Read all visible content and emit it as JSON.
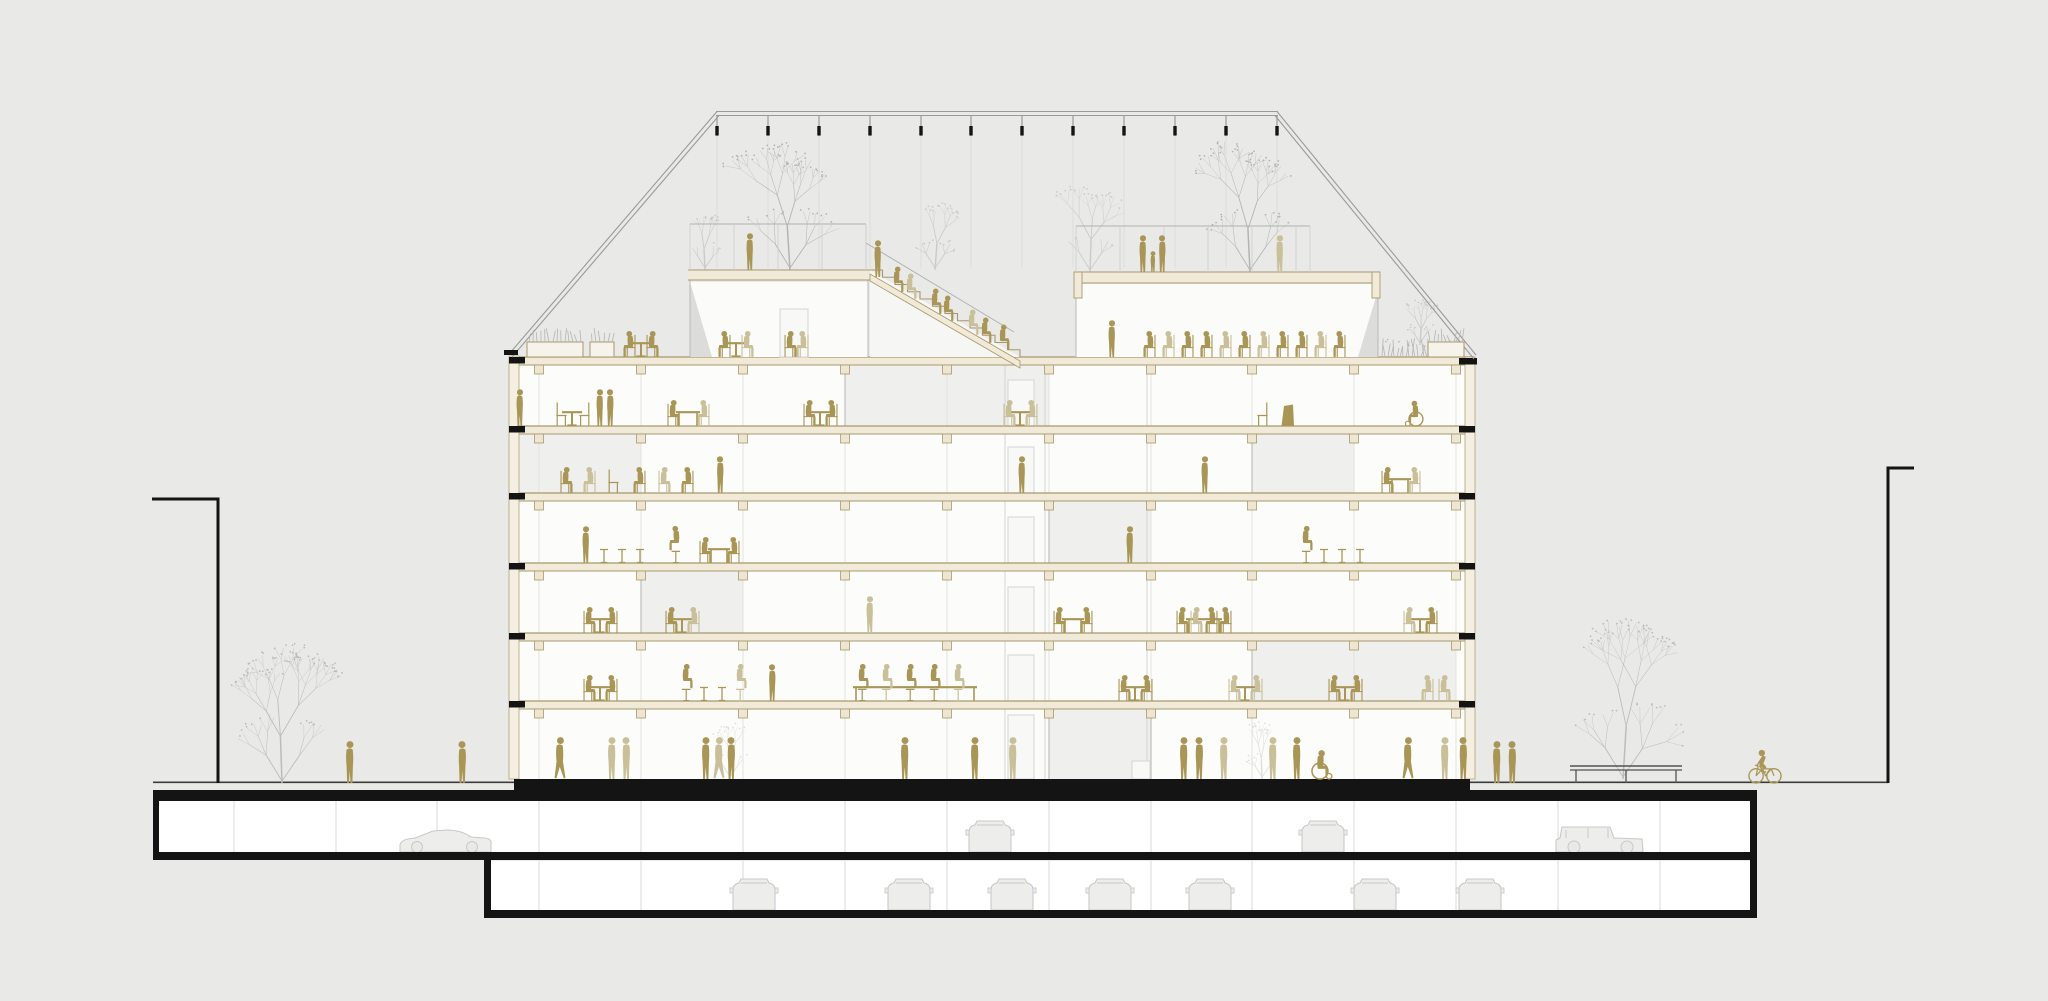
{
  "title": "Building cross-section architectural drawing",
  "canvas": {
    "w": 2048,
    "h": 1001
  },
  "colors": {
    "background": "#e9e9e8",
    "ink": "#141414",
    "street_line": "#3c3c3a",
    "interior": "#fcfcfb",
    "room_tint": "#efefed",
    "pavilion_fill": "#fbfbf9",
    "slab_fill": "#f1ead9",
    "slab_line": "#a8986b",
    "capital_fill": "#eee6d2",
    "wall_fill": "#f4efe1",
    "mullion": "#e2e2e0",
    "partition": "#c6c6c4",
    "shaft": "#d3d3d1",
    "door_line": "#d8d8d6",
    "door_fill": "#f8f8f6",
    "glass_line": "#b9b9b7",
    "sliver": "#dcdcda",
    "rail": "#b1b1af",
    "parapet_pick": "#cfcfcd",
    "pergola": "#9a9a98",
    "cable": "#dcdcda",
    "person_dark": "#a99657",
    "person_light": "#c9c09a",
    "car_line": "#c9c9c7",
    "car_fill": "#ededec",
    "tree_gray": "#b4b4b2",
    "tree_light": "#cbcbc9",
    "tree_street": "#bcbcba",
    "tree_faint": "#e1e0de",
    "bench": "#55534e"
  },
  "pergola": {
    "top_y": 114,
    "x1": 717,
    "x2": 1277,
    "posts": [
      717,
      768,
      819,
      870,
      921,
      971,
      1022,
      1073,
      1124,
      1175,
      1226,
      1277
    ],
    "eave_left": {
      "x": 512,
      "y": 356
    },
    "eave_right": {
      "x": 1474,
      "y": 358
    },
    "cable_y2": 268
  },
  "building": {
    "left": 514,
    "right": 1470,
    "roof_slab_y": 357,
    "slab_ys": [
      357,
      426,
      493,
      563,
      633,
      701
    ],
    "slab_h": 8,
    "ground_y": 779,
    "columns": [
      539,
      641,
      743,
      845,
      947,
      1049,
      1151,
      1252,
      1354,
      1456
    ],
    "floor_bounds": [
      [
        365,
        426
      ],
      [
        434,
        493
      ],
      [
        501,
        563
      ],
      [
        571,
        633
      ],
      [
        641,
        701
      ],
      [
        709,
        779
      ]
    ],
    "tinted_rooms": [
      {
        "floor": 0,
        "x1": 845,
        "x2": 1049
      },
      {
        "floor": 1,
        "x1": 514,
        "x2": 641
      },
      {
        "floor": 1,
        "x1": 1252,
        "x2": 1354
      },
      {
        "floor": 2,
        "x1": 1049,
        "x2": 1151
      },
      {
        "floor": 3,
        "x1": 641,
        "x2": 743
      },
      {
        "floor": 4,
        "x1": 1252,
        "x2": 1456
      },
      {
        "floor": 5,
        "x1": 1049,
        "x2": 1151
      }
    ],
    "partitions": [
      {
        "floor": 0,
        "x": 845
      },
      {
        "floor": 1,
        "x": 1252
      },
      {
        "floor": 2,
        "x": 1049
      },
      {
        "floor": 3,
        "x": 641
      },
      {
        "floor": 4,
        "x": 1252
      },
      {
        "floor": 5,
        "x": 1049
      },
      {
        "floor": 5,
        "x": 1151
      }
    ],
    "shafts": [
      1005,
      1045,
      1147
    ],
    "doors": [
      {
        "floor": 0,
        "x": 1008,
        "w": 26,
        "h": 46
      },
      {
        "floor": 1,
        "x": 1008,
        "w": 26,
        "h": 46
      },
      {
        "floor": 2,
        "x": 1008,
        "w": 26,
        "h": 46
      },
      {
        "floor": 3,
        "x": 1008,
        "w": 26,
        "h": 46
      },
      {
        "floor": 4,
        "x": 1008,
        "w": 26,
        "h": 46
      },
      {
        "floor": 5,
        "x": 1008,
        "w": 26,
        "h": 64
      },
      {
        "floor": 5,
        "x": 1132,
        "w": 18,
        "h": 18
      }
    ]
  },
  "roof": {
    "upper_terrace": {
      "x1": 688,
      "x2": 870,
      "y": 270,
      "h": 10
    },
    "canopy": {
      "x1": 1074,
      "x2": 1380,
      "y": 272,
      "h": 11
    },
    "parapet_rail_y": 224,
    "parapet_ranges": [
      [
        690,
        866,
        224,
        270
      ],
      [
        1076,
        1310,
        226,
        272
      ]
    ],
    "stair": {
      "x1": 870,
      "y1": 270,
      "x2": 1020,
      "y2": 357,
      "steps": 12
    },
    "glass_walls": [
      [
        690,
        270,
        357
      ],
      [
        868,
        270,
        357
      ],
      [
        1076,
        284,
        357
      ],
      [
        1378,
        284,
        357
      ]
    ],
    "slivers": [
      [
        690,
        282,
        712,
        357
      ],
      [
        1378,
        290,
        1358,
        357
      ]
    ]
  },
  "site": {
    "street_y": 783,
    "street_x1": 153,
    "street_x2": 1888,
    "left_mark": {
      "x1": 152,
      "x2": 218,
      "y_top": 499,
      "y_bot": 783
    },
    "right_mark": {
      "x": 1888,
      "y_top": 468,
      "y_bot": 783,
      "tick_x2": 1914
    }
  },
  "basement": {
    "b1": {
      "x1": 153,
      "x2": 1757,
      "top": 790,
      "floor": 852,
      "int_top": 801,
      "int_bot": 852
    },
    "b2": {
      "x1": 484,
      "x2": 1757,
      "top": 858,
      "floor": 910,
      "int_top": 861,
      "int_bot": 910
    },
    "under_building_band": {
      "x1": 514,
      "x2": 1470,
      "y1": 779,
      "y2": 801
    },
    "columns_b1": [
      234,
      336,
      437,
      539,
      641,
      743,
      845,
      947,
      1049,
      1151,
      1252,
      1354,
      1456,
      1558,
      1660
    ],
    "columns_b2": [
      539,
      641,
      743,
      845,
      947,
      1049,
      1151,
      1252,
      1354,
      1456,
      1558,
      1660
    ]
  },
  "cars": [
    {
      "type": "side",
      "x": 445,
      "y": 852,
      "flip": 1
    },
    {
      "type": "front",
      "x": 990,
      "y": 852,
      "flip": 0
    },
    {
      "type": "front",
      "x": 1323,
      "y": 852,
      "flip": 0
    },
    {
      "type": "jeep",
      "x": 1600,
      "y": 852,
      "flip": 0
    },
    {
      "type": "front",
      "x": 754,
      "y": 910,
      "flip": 0
    },
    {
      "type": "front",
      "x": 909,
      "y": 910,
      "flip": 0
    },
    {
      "type": "front",
      "x": 1012,
      "y": 910,
      "flip": 0
    },
    {
      "type": "front",
      "x": 1110,
      "y": 910,
      "flip": 0
    },
    {
      "type": "front",
      "x": 1210,
      "y": 910,
      "flip": 0
    },
    {
      "type": "front",
      "x": 1375,
      "y": 910,
      "flip": 0
    },
    {
      "type": "front",
      "x": 1480,
      "y": 910,
      "flip": 0
    }
  ],
  "trees": [
    {
      "x": 790,
      "y": 270,
      "h": 128,
      "tone": "tree_gray",
      "seed": 11
    },
    {
      "x": 705,
      "y": 270,
      "h": 62,
      "tone": "tree_light",
      "seed": 12
    },
    {
      "x": 935,
      "y": 270,
      "h": 78,
      "tone": "tree_light",
      "seed": 13
    },
    {
      "x": 1090,
      "y": 272,
      "h": 96,
      "tone": "tree_light",
      "seed": 14
    },
    {
      "x": 1250,
      "y": 272,
      "h": 126,
      "tone": "tree_gray",
      "seed": 15
    },
    {
      "x": 1420,
      "y": 345,
      "h": 46,
      "tone": "tree_light",
      "seed": 16
    },
    {
      "x": 282,
      "y": 783,
      "h": 138,
      "tone": "tree_street",
      "seed": 17
    },
    {
      "x": 1623,
      "y": 779,
      "h": 156,
      "tone": "tree_street",
      "seed": 18
    },
    {
      "x": 730,
      "y": 779,
      "h": 62,
      "tone": "tree_faint",
      "seed": 19
    },
    {
      "x": 1262,
      "y": 779,
      "h": 60,
      "tone": "tree_faint",
      "seed": 20
    }
  ],
  "furniture": [
    [
      "planter",
      527,
      357,
      0,
      56
    ],
    [
      "planter",
      590,
      357,
      0,
      24
    ],
    [
      "tableRound",
      641,
      357,
      0,
      24
    ],
    [
      "tableRound",
      736,
      357,
      0,
      24
    ],
    [
      "shrubs",
      1382,
      357,
      0,
      78
    ],
    [
      "planterBox",
      1428,
      357,
      0,
      36
    ],
    [
      "chairEmpty",
      562,
      426,
      0
    ],
    [
      "tableRound",
      572,
      426,
      0,
      20
    ],
    [
      "chairEmpty",
      584,
      426,
      1
    ],
    [
      "tableMeet",
      688,
      426,
      0,
      24
    ],
    [
      "tableRound",
      820,
      426,
      0,
      24
    ],
    [
      "tableRound",
      1020,
      426,
      0,
      24
    ],
    [
      "chairEmpty",
      1262,
      426,
      1
    ],
    [
      "lectern",
      1288,
      426,
      0
    ],
    [
      "chairEmpty",
      614,
      493,
      0
    ],
    [
      "tableMeet",
      1400,
      493,
      0,
      22
    ],
    [
      "stool",
      604,
      563
    ],
    [
      "stool",
      622,
      563
    ],
    [
      "stool",
      640,
      563
    ],
    [
      "tableMeet",
      719,
      563,
      0,
      22
    ],
    [
      "stool",
      1324,
      563
    ],
    [
      "stool",
      1342,
      563
    ],
    [
      "stool",
      1360,
      563
    ],
    [
      "tableRound",
      600,
      633,
      0,
      22
    ],
    [
      "tableRound",
      682,
      633,
      0,
      22
    ],
    [
      "tableMeet",
      1073,
      633,
      0,
      22
    ],
    [
      "tableMeet",
      1204,
      633,
      0,
      36
    ],
    [
      "tableRound",
      1420,
      633,
      0,
      22
    ],
    [
      "tableRound",
      600,
      701,
      0,
      22
    ],
    [
      "stool",
      704,
      701
    ],
    [
      "stool",
      722,
      701
    ],
    [
      "tableMeet",
      915,
      701,
      0,
      124
    ],
    [
      "tableRound",
      1135,
      701,
      0,
      22
    ],
    [
      "tableRound",
      1245,
      701,
      0,
      22
    ],
    [
      "tableRound",
      1345,
      701,
      0,
      22
    ],
    [
      "bench",
      1626,
      783,
      0,
      112
    ]
  ],
  "figures": [
    [
      "sitChair",
      630,
      357,
      "d",
      1
    ],
    [
      "sitChair",
      652,
      357,
      "d",
      0
    ],
    [
      "sitChair",
      725,
      357,
      "d",
      1
    ],
    [
      "sitChair",
      747,
      357,
      "l",
      0
    ],
    [
      "sitChair",
      790,
      357,
      "d",
      0
    ],
    [
      "sitChair",
      803,
      357,
      "l",
      1
    ],
    [
      "stand",
      750,
      270,
      "d",
      0
    ],
    [
      "stand",
      878,
      277,
      "d",
      0
    ],
    [
      "sitStep",
      897,
      292,
      "d",
      0
    ],
    [
      "sitStep",
      910,
      299,
      "l",
      0
    ],
    [
      "sitStep",
      935,
      314,
      "d",
      0
    ],
    [
      "sitStep",
      947,
      321,
      "d",
      0
    ],
    [
      "sitStep",
      972,
      335,
      "l",
      0
    ],
    [
      "sitStep",
      985,
      343,
      "d",
      0
    ],
    [
      "sitStep",
      1003,
      350,
      "d",
      0
    ],
    [
      "stand",
      1143,
      272,
      "d",
      0
    ],
    [
      "child",
      1153,
      272,
      "d",
      0
    ],
    [
      "stand",
      1162,
      272,
      "d",
      1
    ],
    [
      "stand",
      1280,
      272,
      "l",
      0
    ],
    [
      "stand",
      1112,
      357,
      "d",
      0
    ],
    [
      "sitChair",
      1150,
      357,
      "d",
      1
    ],
    [
      "sitChair",
      1169,
      357,
      "l",
      1
    ],
    [
      "sitChair",
      1188,
      357,
      "d",
      1
    ],
    [
      "sitChair",
      1207,
      357,
      "d",
      1
    ],
    [
      "sitChair",
      1226,
      357,
      "l",
      1
    ],
    [
      "sitChair",
      1245,
      357,
      "d",
      1
    ],
    [
      "sitChair",
      1264,
      357,
      "l",
      1
    ],
    [
      "sitChair",
      1283,
      357,
      "d",
      1
    ],
    [
      "sitChair",
      1302,
      357,
      "d",
      1
    ],
    [
      "sitChair",
      1321,
      357,
      "l",
      1
    ],
    [
      "sitChair",
      1340,
      357,
      "d",
      1
    ],
    [
      "stand",
      520,
      426,
      "d",
      0
    ],
    [
      "stand",
      600,
      426,
      "d",
      0
    ],
    [
      "stand",
      610,
      426,
      "d",
      1
    ],
    [
      "sitChair",
      673,
      426,
      "d",
      0
    ],
    [
      "sitChair",
      704,
      426,
      "l",
      1
    ],
    [
      "sitChair",
      809,
      426,
      "d",
      0
    ],
    [
      "sitChair",
      832,
      426,
      "d",
      1
    ],
    [
      "sitChair",
      1009,
      426,
      "l",
      0
    ],
    [
      "sitChair",
      1032,
      426,
      "l",
      1
    ],
    [
      "wheelchair",
      1415,
      426,
      "d",
      1
    ],
    [
      "sitChair",
      566,
      493,
      "d",
      0
    ],
    [
      "sitChair",
      590,
      493,
      "l",
      1
    ],
    [
      "sitChair",
      640,
      493,
      "d",
      1
    ],
    [
      "sitChair",
      664,
      493,
      "l",
      0
    ],
    [
      "sitChair",
      688,
      493,
      "d",
      1
    ],
    [
      "stand",
      720,
      493,
      "d",
      1
    ],
    [
      "stand",
      1022,
      493,
      "d",
      0
    ],
    [
      "stand",
      1205,
      493,
      "d",
      0
    ],
    [
      "sitChair",
      1387,
      493,
      "d",
      0
    ],
    [
      "sitChair",
      1415,
      493,
      "l",
      1
    ],
    [
      "stand",
      586,
      563,
      "d",
      0
    ],
    [
      "sitStool",
      676,
      563,
      "d",
      1
    ],
    [
      "sitChair",
      705,
      563,
      "d",
      0
    ],
    [
      "sitChair",
      734,
      563,
      "d",
      1
    ],
    [
      "stand",
      1130,
      563,
      "d",
      0
    ],
    [
      "sitStool",
      1306,
      563,
      "d",
      0
    ],
    [
      "sitChair",
      589,
      633,
      "d",
      0
    ],
    [
      "sitChair",
      612,
      633,
      "d",
      1
    ],
    [
      "sitChair",
      671,
      633,
      "d",
      0
    ],
    [
      "sitChair",
      694,
      633,
      "l",
      1
    ],
    [
      "stand",
      870,
      633,
      "l",
      0
    ],
    [
      "sitChair",
      1059,
      633,
      "d",
      0
    ],
    [
      "sitChair",
      1087,
      633,
      "d",
      1
    ],
    [
      "sitChair",
      1182,
      633,
      "d",
      0
    ],
    [
      "sitChair",
      1196,
      633,
      "l",
      0
    ],
    [
      "sitChair",
      1212,
      633,
      "d",
      1
    ],
    [
      "sitChair",
      1226,
      633,
      "d",
      1
    ],
    [
      "sitChair",
      1409,
      633,
      "l",
      0
    ],
    [
      "sitChair",
      1432,
      633,
      "d",
      1
    ],
    [
      "sitChair",
      589,
      701,
      "d",
      0
    ],
    [
      "sitChair",
      612,
      701,
      "d",
      1
    ],
    [
      "sitStool",
      686,
      701,
      "d",
      0
    ],
    [
      "sitStool",
      740,
      701,
      "l",
      0
    ],
    [
      "stand",
      772,
      701,
      "d",
      1
    ],
    [
      "sitStool",
      862,
      701,
      "d",
      0
    ],
    [
      "sitStool",
      886,
      701,
      "l",
      0
    ],
    [
      "sitStool",
      910,
      701,
      "d",
      0
    ],
    [
      "sitStool",
      934,
      701,
      "d",
      0
    ],
    [
      "sitStool",
      958,
      701,
      "l",
      0
    ],
    [
      "sitChair",
      1124,
      701,
      "d",
      0
    ],
    [
      "sitChair",
      1147,
      701,
      "d",
      1
    ],
    [
      "sitChair",
      1234,
      701,
      "l",
      0
    ],
    [
      "sitChair",
      1257,
      701,
      "l",
      1
    ],
    [
      "sitChair",
      1334,
      701,
      "d",
      0
    ],
    [
      "sitChair",
      1357,
      701,
      "d",
      1
    ],
    [
      "sitChair",
      1428,
      701,
      "l",
      1
    ],
    [
      "sitChair",
      1444,
      701,
      "l",
      0
    ],
    [
      "walk",
      560,
      779,
      "d",
      0
    ],
    [
      "stand",
      612,
      779,
      "l",
      0
    ],
    [
      "stand",
      626,
      779,
      "l",
      1
    ],
    [
      "stand",
      706,
      779,
      "d",
      0
    ],
    [
      "walk",
      719,
      779,
      "l",
      0
    ],
    [
      "stand",
      731,
      779,
      "d",
      1
    ],
    [
      "stand",
      905,
      779,
      "d",
      0
    ],
    [
      "stand",
      975,
      779,
      "d",
      0
    ],
    [
      "stand",
      1013,
      779,
      "l",
      0
    ],
    [
      "stand",
      1184,
      779,
      "d",
      0
    ],
    [
      "stand",
      1199,
      779,
      "d",
      1
    ],
    [
      "stand",
      1224,
      779,
      "l",
      0
    ],
    [
      "stand",
      1273,
      779,
      "l",
      0
    ],
    [
      "stand",
      1297,
      779,
      "d",
      0
    ],
    [
      "wheelchair",
      1321,
      779,
      "d",
      0
    ],
    [
      "walk",
      1408,
      779,
      "d",
      0
    ],
    [
      "stand",
      1445,
      779,
      "l",
      0
    ],
    [
      "stand",
      1463,
      779,
      "d",
      1
    ],
    [
      "stand",
      350,
      783,
      "d",
      0
    ],
    [
      "stand",
      462,
      783,
      "d",
      1
    ],
    [
      "stand",
      1497,
      783,
      "d",
      0
    ],
    [
      "stand",
      1512,
      783,
      "d",
      1
    ],
    [
      "bike",
      1765,
      783,
      "d",
      0
    ]
  ]
}
